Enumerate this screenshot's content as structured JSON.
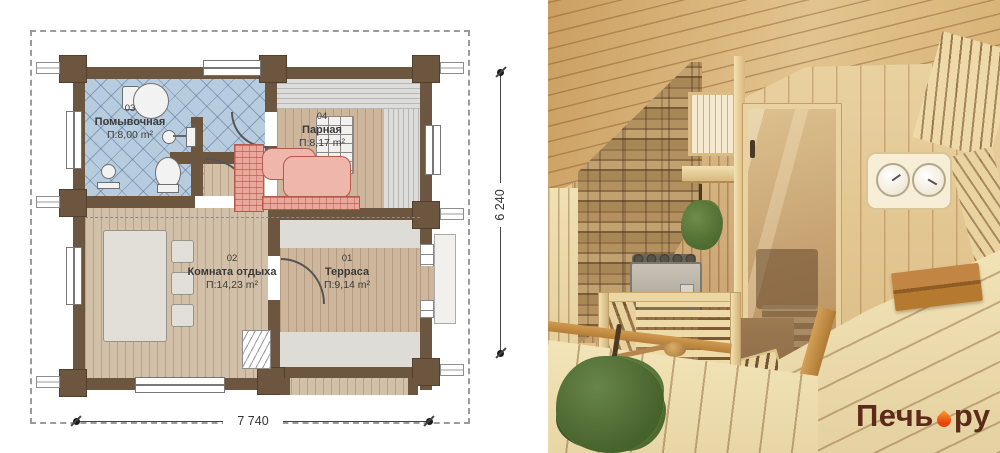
{
  "plan": {
    "rooms": [
      {
        "number": "03",
        "name": "Помывочная",
        "area": "П:8,00 m²"
      },
      {
        "number": "04",
        "name": "Парная",
        "area": "П:8,17 m²"
      },
      {
        "number": "02",
        "name": "Комната отдыха",
        "area": "П:14,23 m²"
      },
      {
        "number": "01",
        "name": "Терраса",
        "area": "П:9,14 m²"
      }
    ],
    "dimensions": {
      "width": "7 740",
      "height": "6 240"
    }
  },
  "photo": {
    "watermark": {
      "brand": "Печь",
      "suffix": "ру",
      "separator_icon": "flame-icon"
    }
  },
  "colors": {
    "wall_brown": "#6d5640",
    "tile_blue": "#b7cddf",
    "wood_tan": "#d3c0a9",
    "bench_pink": "#eaa89d",
    "bench_gray": "#dcdcda",
    "watermark_maroon": "#5d2a18",
    "flame_orange": "#e8430a"
  }
}
